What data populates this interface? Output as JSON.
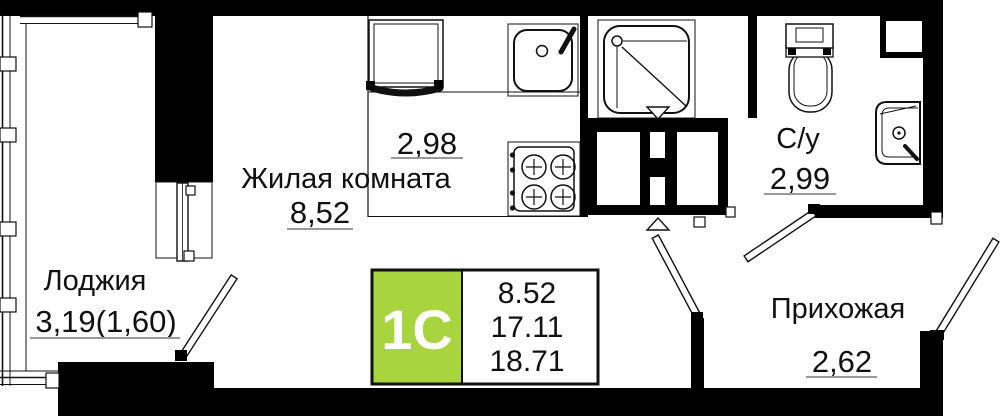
{
  "plan": {
    "badge": {
      "label": "1С",
      "values": [
        "8.52",
        "17.11",
        "18.71"
      ]
    },
    "rooms": {
      "living": {
        "name": "Жилая комната",
        "area": "8,52"
      },
      "kitchen": {
        "area": "2,98"
      },
      "loggia": {
        "name": "Лоджия",
        "area": "3,19(1,60)"
      },
      "bathroom": {
        "name": "С/у",
        "area": "2,99"
      },
      "hallway": {
        "name": "Прихожая",
        "area": "2,62"
      }
    },
    "colors": {
      "wall": "#000000",
      "badge_green": "#a8d43d",
      "underline": "#999999",
      "text": "#111111"
    }
  }
}
